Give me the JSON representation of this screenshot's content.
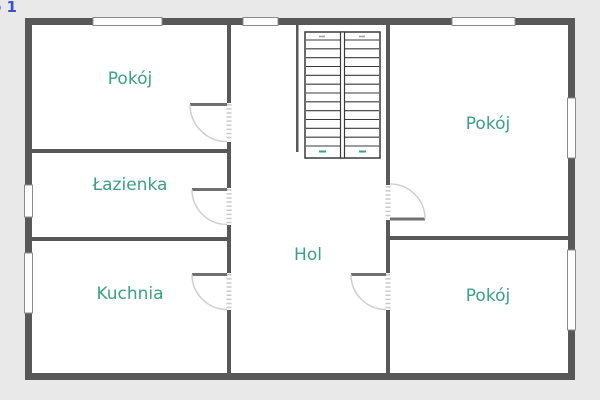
{
  "page": {
    "floor_label_fragment": "o 1"
  },
  "colors": {
    "bg": "#e9e9e9",
    "wall": "#585858",
    "label": "#3aa184",
    "floor_label": "#3b4ed0",
    "arc": "#cfcfcf",
    "leaf": "#707070",
    "stair_line": "#3a3a3a",
    "marker": "#3aa184"
  },
  "rooms": [
    {
      "id": "pokoj-top-left",
      "label": "Pokój"
    },
    {
      "id": "lazienka",
      "label": "Łazienka"
    },
    {
      "id": "kuchnia",
      "label": "Kuchnia"
    },
    {
      "id": "hol",
      "label": "Hol"
    },
    {
      "id": "pokoj-top-right",
      "label": "Pokój"
    },
    {
      "id": "pokoj-bottom-right",
      "label": "Pokój"
    }
  ],
  "staircase": {
    "flights": 2,
    "steps_per_flight": 13
  }
}
